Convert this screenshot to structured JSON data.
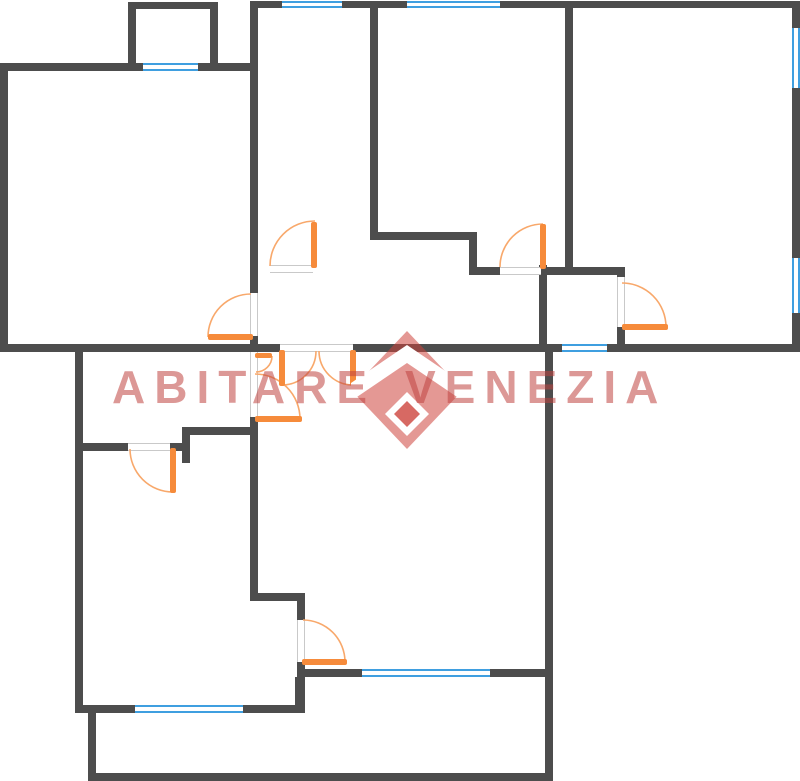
{
  "watermark": {
    "word1": "ABITARE",
    "word2": "VENEZIA",
    "word1_pos": {
      "left": 112,
      "top": 360
    },
    "word2_pos": {
      "left": 405,
      "top": 360
    },
    "text_color": "rgba(191,68,64,0.55)",
    "logo": {
      "pos": {
        "left": 351,
        "top": 330,
        "w": 112,
        "h": 120
      },
      "red": "rgba(205,68,60,0.55)",
      "red_solid": "rgba(205,68,60,0.8)",
      "white": "#ffffff",
      "polygons": [
        {
          "points": "56,1 112,60 56,119 0,60",
          "fill": "red"
        },
        {
          "points": "0,53 56,15 112,53 112,71 56,33 0,71",
          "fill": "white"
        },
        {
          "points": "56,62 78,84 56,106 34,84",
          "fill": "white"
        },
        {
          "points": "56,71 69,84 56,97 43,84",
          "fill": "red_solid"
        }
      ]
    }
  },
  "plan": {
    "canvas": {
      "w": 800,
      "h": 781
    },
    "colors": {
      "wall": "#4d4d4d",
      "window_frame": "#3f9fe0",
      "jamb": "#c9c9c9",
      "door_leaf": "#f68b3b",
      "door_arc": "#f8a86b",
      "background": "#ffffff"
    },
    "walls": [
      [
        128,
        2,
        8,
        61
      ],
      [
        128,
        2,
        90,
        7
      ],
      [
        210,
        2,
        8,
        61
      ],
      [
        0,
        63,
        255,
        8
      ],
      [
        0,
        63,
        8,
        289
      ],
      [
        0,
        344,
        280,
        8
      ],
      [
        353,
        344,
        209,
        8
      ],
      [
        607,
        344,
        193,
        8
      ],
      [
        250,
        1,
        8,
        292
      ],
      [
        250,
        336,
        8,
        16
      ],
      [
        252,
        1,
        548,
        7
      ],
      [
        370,
        1,
        8,
        239
      ],
      [
        370,
        232,
        107,
        8
      ],
      [
        469,
        240,
        8,
        35
      ],
      [
        477,
        267,
        24,
        8
      ],
      [
        541,
        267,
        33,
        8
      ],
      [
        565,
        1,
        8,
        272
      ],
      [
        539,
        265,
        8,
        87
      ],
      [
        573,
        267,
        52,
        8
      ],
      [
        617,
        271,
        8,
        6
      ],
      [
        617,
        327,
        8,
        25
      ],
      [
        792,
        1,
        8,
        351
      ],
      [
        75,
        350,
        8,
        363
      ],
      [
        182,
        427,
        76,
        8
      ],
      [
        182,
        435,
        8,
        28
      ],
      [
        78,
        443,
        50,
        8
      ],
      [
        170,
        443,
        18,
        8
      ],
      [
        250,
        417,
        8,
        184
      ],
      [
        250,
        593,
        55,
        8
      ],
      [
        297,
        601,
        8,
        19
      ],
      [
        297,
        662,
        8,
        15
      ],
      [
        297,
        669,
        65,
        8
      ],
      [
        490,
        669,
        57,
        8
      ],
      [
        78,
        705,
        57,
        8
      ],
      [
        243,
        705,
        62,
        8
      ],
      [
        295,
        677,
        10,
        36
      ],
      [
        88,
        713,
        8,
        62
      ],
      [
        88,
        773,
        465,
        8
      ],
      [
        545,
        344,
        8,
        437
      ]
    ],
    "windows": [
      {
        "x": 143,
        "y": 63,
        "w": 55,
        "h": 8,
        "o": "h"
      },
      {
        "x": 282,
        "y": 1,
        "w": 60,
        "h": 7,
        "o": "h"
      },
      {
        "x": 407,
        "y": 1,
        "w": 93,
        "h": 7,
        "o": "h"
      },
      {
        "x": 792,
        "y": 28,
        "w": 8,
        "h": 60,
        "o": "v"
      },
      {
        "x": 792,
        "y": 258,
        "w": 8,
        "h": 55,
        "o": "v"
      },
      {
        "x": 562,
        "y": 344,
        "w": 45,
        "h": 8,
        "o": "h"
      },
      {
        "x": 362,
        "y": 669,
        "w": 128,
        "h": 8,
        "o": "h"
      },
      {
        "x": 135,
        "y": 705,
        "w": 108,
        "h": 8,
        "o": "h"
      }
    ],
    "openings": [
      {
        "x": 270,
        "y": 265,
        "w": 43,
        "h": 8,
        "o": "h"
      },
      {
        "x": 500,
        "y": 267,
        "w": 41,
        "h": 8,
        "o": "h"
      },
      {
        "x": 617,
        "y": 277,
        "w": 8,
        "h": 50,
        "o": "v"
      },
      {
        "x": 250,
        "y": 293,
        "w": 8,
        "h": 43,
        "o": "v"
      },
      {
        "x": 250,
        "y": 352,
        "w": 8,
        "h": 65,
        "o": "v"
      },
      {
        "x": 280,
        "y": 344,
        "w": 73,
        "h": 8,
        "o": "h"
      },
      {
        "x": 128,
        "y": 443,
        "w": 42,
        "h": 8,
        "o": "h"
      },
      {
        "x": 297,
        "y": 620,
        "w": 8,
        "h": 42,
        "o": "v"
      }
    ],
    "door_leaves": [
      [
        311,
        222,
        6,
        46
      ],
      [
        540,
        224,
        6,
        45
      ],
      [
        622,
        324,
        46,
        6
      ],
      [
        208,
        334,
        45,
        6
      ],
      [
        255,
        416,
        47,
        6
      ],
      [
        255,
        353,
        17,
        5
      ],
      [
        279,
        350,
        6,
        36
      ],
      [
        350,
        350,
        6,
        36
      ],
      [
        170,
        448,
        6,
        45
      ],
      [
        302,
        659,
        45,
        6
      ]
    ],
    "door_arcs": [
      [
        270,
        266,
        315,
        221,
        45,
        1
      ],
      [
        500,
        267,
        543,
        224,
        43,
        1
      ],
      [
        622,
        283,
        666,
        327,
        44,
        1
      ],
      [
        208,
        337,
        251,
        294,
        43,
        1
      ],
      [
        255,
        374,
        300,
        419,
        45,
        1
      ],
      [
        272,
        356,
        256,
        372,
        16,
        1
      ],
      [
        282,
        385,
        316,
        351,
        34,
        0
      ],
      [
        353,
        385,
        319,
        351,
        34,
        1
      ],
      [
        130,
        449,
        173,
        492,
        43,
        0
      ],
      [
        303,
        620,
        345,
        662,
        42,
        1
      ]
    ]
  }
}
